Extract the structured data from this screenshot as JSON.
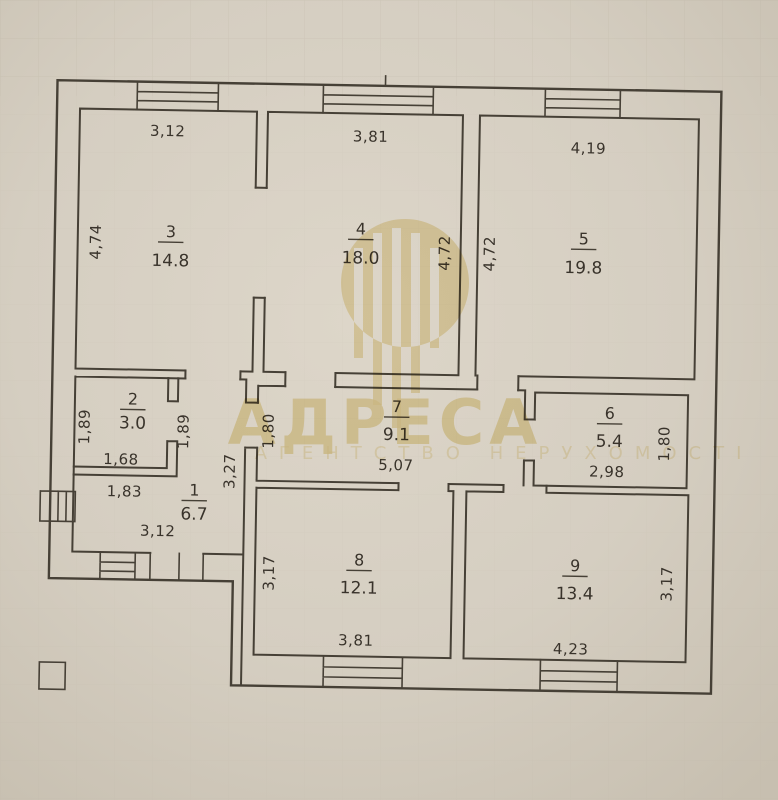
{
  "photo": {
    "background_color": "#d5cec1",
    "wall_color": "#464036",
    "text_color": "#39332b"
  },
  "watermark": {
    "brand": "АДРЕСА",
    "subtitle": "АГЕНТСТВО НЕРУХОМОСТІ",
    "accent_color": "#ecdca6"
  },
  "plan": {
    "rooms": [
      {
        "number": "1",
        "area": "6.7",
        "dims": {
          "top": "1,83",
          "bottom": "3,12",
          "right": "3,27"
        }
      },
      {
        "number": "2",
        "area": "3.0",
        "dims": {
          "left": "1,89",
          "bottom": "1,68",
          "right": "1,89"
        }
      },
      {
        "number": "3",
        "area": "14.8",
        "dims": {
          "top": "3,12",
          "left": "4,74"
        }
      },
      {
        "number": "4",
        "area": "18.0",
        "dims": {
          "top": "3,81",
          "right": "4,72"
        }
      },
      {
        "number": "5",
        "area": "19.8",
        "dims": {
          "top": "4,19",
          "left": "4,72"
        }
      },
      {
        "number": "6",
        "area": "5.4",
        "dims": {
          "bottom": "2,98",
          "right": "1,80"
        }
      },
      {
        "number": "7",
        "area": "9.1",
        "dims": {
          "left": "1,80",
          "bottom": "5,07"
        }
      },
      {
        "number": "8",
        "area": "12.1",
        "dims": {
          "left": "3,17",
          "bottom": "3,81"
        }
      },
      {
        "number": "9",
        "area": "13.4",
        "dims": {
          "bottom": "4,23",
          "right": "3,17"
        }
      }
    ]
  }
}
